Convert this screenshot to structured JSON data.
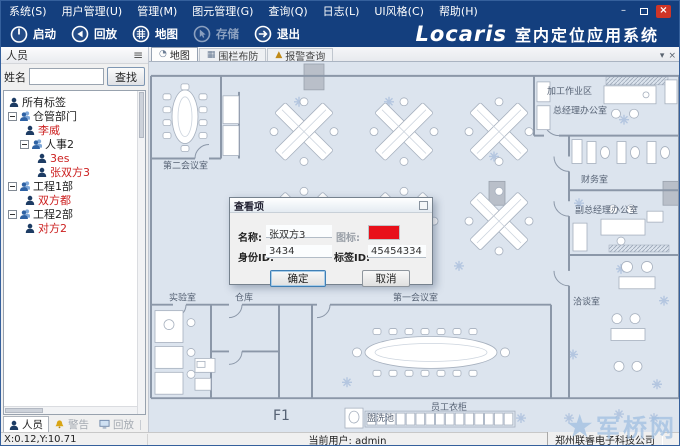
{
  "menu": {
    "items": [
      {
        "label": "系统(S)"
      },
      {
        "label": "用户管理(U)"
      },
      {
        "label": "管理(M)"
      },
      {
        "label": "图元管理(G)"
      },
      {
        "label": "查询(Q)"
      },
      {
        "label": "日志(L)"
      },
      {
        "label": "UI风格(C)"
      },
      {
        "label": "帮助(H)"
      }
    ]
  },
  "window_controls": {
    "minimize": "–",
    "close": "×"
  },
  "toolbar": {
    "buttons": [
      {
        "label": "启动"
      },
      {
        "label": "回放"
      },
      {
        "label": "地图"
      },
      {
        "label": "存储"
      },
      {
        "label": "退出"
      }
    ],
    "brand": "Locaris",
    "brand_suffix": "室内定位应用系统"
  },
  "sidebar": {
    "title": "人员",
    "menu_icon": "≡",
    "search_label": "姓名",
    "search_value": "",
    "search_button": "查找",
    "tree": [
      {
        "label": "所有标签"
      },
      {
        "label": "仓管部门"
      },
      {
        "label": "李威"
      },
      {
        "label": "人事2"
      },
      {
        "label": "3es"
      },
      {
        "label": "张双方3"
      },
      {
        "label": "工程1部"
      },
      {
        "label": "双方都"
      },
      {
        "label": "工程2部"
      },
      {
        "label": "对方2"
      }
    ],
    "tabs": [
      {
        "label": "人员"
      },
      {
        "label": "警告"
      },
      {
        "label": "回放"
      }
    ]
  },
  "main": {
    "tabs": [
      {
        "label": "地图",
        "icon": "◔"
      },
      {
        "label": "围栏布防",
        "icon": "▦"
      },
      {
        "label": "报警查询",
        "icon": "▲"
      }
    ],
    "tab_dropdown": "▾",
    "tab_close": "×"
  },
  "map": {
    "labels": {
      "processing_area": "加工作业区",
      "meeting_room_2": "第二会议室",
      "gm_office": "总经理办公室",
      "finance_office": "财务室",
      "deputy_gm_office": "副总经理办公室",
      "negotiation_room": "洽谈室",
      "laboratory": "实验室",
      "warehouse": "仓库",
      "meeting_room_1": "第一会议室",
      "floor_label": "F1",
      "wash_basin": "盥洗池",
      "staff_lockers": "员工衣柜"
    }
  },
  "dialog": {
    "title": "查看项",
    "name_label": "名称:",
    "name_value": "张双方3",
    "icon_label": "图标:",
    "icon_color": "#e8101a",
    "id_label": "身份ID:",
    "id_value": "3434",
    "tag_label": "标签ID:",
    "tag_value": "45454334",
    "ok_label": "确定",
    "cancel_label": "取消"
  },
  "statusbar": {
    "coords": "X:0.12,Y:10.71",
    "user": "当前用户: admin",
    "company": "郑州联睿电子科技公司"
  },
  "watermark": {
    "star": "★",
    "text": "军桥网"
  }
}
